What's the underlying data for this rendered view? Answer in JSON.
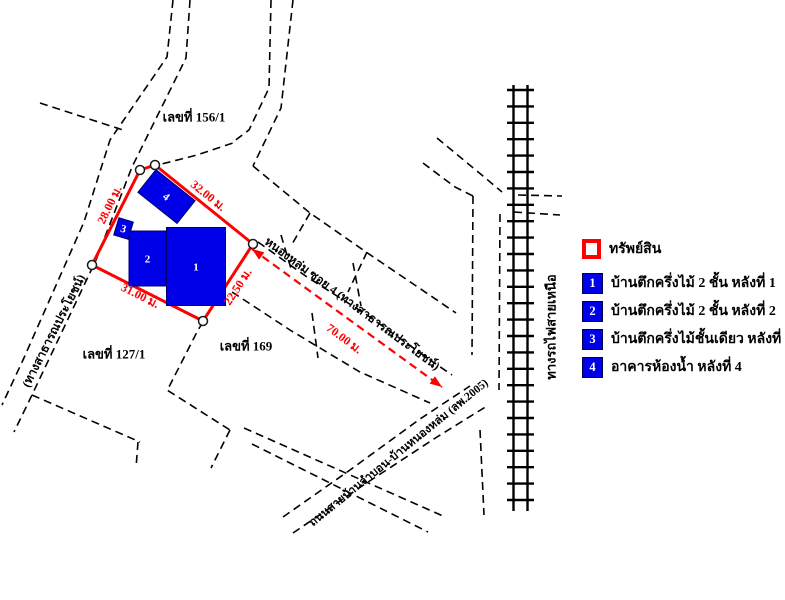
{
  "colors": {
    "property_outline": "#ff0000",
    "building_fill": "#0000e8",
    "measure_text": "#ff0000",
    "road_line": "#000000"
  },
  "legend": {
    "property_label": "ทรัพย์สิน",
    "items": [
      {
        "num": "1",
        "label": "บ้านตึกครึ่งไม้ 2 ชั้น หลังที่ 1"
      },
      {
        "num": "2",
        "label": "บ้านตึกครึ่งไม้ 2 ชั้น หลังที่ 2"
      },
      {
        "num": "3",
        "label": "บ้านตึกครึ่งไม้ชั้นเดียว หลังที่ 3"
      },
      {
        "num": "4",
        "label": "อาคารห้องน้ำ หลังที่ 4"
      }
    ]
  },
  "map": {
    "property": {
      "outline": [
        [
          140,
          170
        ],
        [
          155,
          165
        ],
        [
          253,
          244
        ],
        [
          203,
          321
        ],
        [
          92,
          265
        ]
      ]
    },
    "buildings": [
      {
        "num": "1",
        "cx": 196,
        "cy": 266.5,
        "w": 59,
        "h": 78,
        "rotate": 0
      },
      {
        "num": "2",
        "cx": 147.5,
        "cy": 258.5,
        "w": 37,
        "h": 55,
        "rotate": 0
      },
      {
        "num": "3",
        "cx": 123.5,
        "cy": 228.5,
        "w": 15,
        "h": 18,
        "rotate": 17
      },
      {
        "num": "4",
        "cx": 166.5,
        "cy": 196.5,
        "w": 50,
        "h": 29,
        "rotate": 38.5
      }
    ],
    "railway": {
      "rail_west_x": 513.5,
      "rail_east_x": 527.5,
      "y_top": 85,
      "y_bottom": 511,
      "tie_x1": 507,
      "tie_x2": 534,
      "tie_start": 90,
      "tie_step": 16.4
    },
    "measure_arrow": {
      "from": [
        252,
        249
      ],
      "to": [
        442,
        387
      ]
    },
    "roads": [
      {
        "name": "left-road-west",
        "pts": [
          [
            173,
            0
          ],
          [
            167,
            57
          ],
          [
            110,
            140
          ],
          [
            84,
            222
          ],
          [
            23,
            360
          ],
          [
            2,
            405
          ]
        ]
      },
      {
        "name": "left-road-east",
        "pts": [
          [
            190,
            0
          ],
          [
            186,
            58
          ],
          [
            132,
            167
          ],
          [
            96,
            260
          ],
          [
            32,
            395
          ],
          [
            14,
            432
          ]
        ]
      },
      {
        "name": "top-cross-line",
        "pts": [
          [
            40,
            103
          ],
          [
            123,
            130
          ]
        ]
      },
      {
        "name": "north-boundary",
        "pts": [
          [
            150,
            167
          ],
          [
            197,
            155
          ],
          [
            233,
            143
          ]
        ]
      },
      {
        "name": "road156-west",
        "pts": [
          [
            271,
            0
          ],
          [
            269,
            88
          ],
          [
            249,
            130
          ],
          [
            233,
            142
          ]
        ]
      },
      {
        "name": "road156-east",
        "pts": [
          [
            293,
            0
          ],
          [
            281,
            108
          ],
          [
            253,
            166
          ]
        ]
      },
      {
        "name": "ne-parallel",
        "pts": [
          [
            253,
            166
          ],
          [
            310,
            213
          ],
          [
            366,
            252
          ],
          [
            431,
            296
          ],
          [
            456,
            313
          ]
        ]
      },
      {
        "name": "ne-stub-1",
        "pts": [
          [
            310,
            213
          ],
          [
            291,
            246
          ]
        ]
      },
      {
        "name": "ne-stub-2",
        "pts": [
          [
            367,
            252
          ],
          [
            348,
            292
          ]
        ]
      },
      {
        "name": "soi-north-edge",
        "pts": [
          [
            258,
            242
          ],
          [
            307,
            277
          ],
          [
            367,
            315
          ],
          [
            433,
            362
          ],
          [
            452,
            375
          ]
        ]
      },
      {
        "name": "soi-south-edge",
        "pts": [
          [
            232,
            292
          ],
          [
            290,
            330
          ],
          [
            360,
            372
          ],
          [
            430,
            403
          ]
        ]
      },
      {
        "name": "soi-tick-1",
        "pts": [
          [
            281,
            235
          ],
          [
            292,
            272
          ]
        ]
      },
      {
        "name": "soi-tick-2",
        "pts": [
          [
            353,
            263
          ],
          [
            361,
            306
          ]
        ]
      },
      {
        "name": "soi-tick-3",
        "pts": [
          [
            312,
            313
          ],
          [
            318,
            358
          ]
        ]
      },
      {
        "name": "parcel-169-west",
        "pts": [
          [
            203,
            322
          ],
          [
            198,
            330
          ],
          [
            170,
            385
          ],
          [
            167,
            390
          ],
          [
            230,
            430
          ]
        ]
      },
      {
        "name": "parcel-169-stub",
        "pts": [
          [
            230,
            430
          ],
          [
            211,
            468
          ]
        ]
      },
      {
        "name": "parcel-127-south",
        "pts": [
          [
            32,
            395
          ],
          [
            140,
            442
          ]
        ]
      },
      {
        "name": "parcel-127-stub",
        "pts": [
          [
            138,
            442
          ],
          [
            136,
            468
          ]
        ]
      },
      {
        "name": "cross-road-north",
        "pts": [
          [
            244,
            428
          ],
          [
            443,
            516
          ]
        ]
      },
      {
        "name": "cross-road-south",
        "pts": [
          [
            252,
            444
          ],
          [
            428,
            532
          ]
        ]
      },
      {
        "name": "main-road-north",
        "pts": [
          [
            283,
            517
          ],
          [
            350,
            470
          ],
          [
            420,
            419
          ],
          [
            470,
            386
          ]
        ]
      },
      {
        "name": "main-road-south",
        "pts": [
          [
            293,
            533
          ],
          [
            365,
            484
          ],
          [
            437,
            437
          ],
          [
            487,
            406
          ]
        ]
      },
      {
        "name": "rail-stub-north",
        "pts": [
          [
            437,
            138
          ],
          [
            483,
            176
          ],
          [
            502,
            192
          ]
        ]
      },
      {
        "name": "rail-stub-south",
        "pts": [
          [
            423,
            163
          ],
          [
            455,
            187
          ],
          [
            473,
            196
          ]
        ]
      },
      {
        "name": "rail-east-1",
        "pts": [
          [
            518,
            195
          ],
          [
            562,
            196
          ]
        ]
      },
      {
        "name": "rail-east-2",
        "pts": [
          [
            514,
            212
          ],
          [
            560,
            215
          ]
        ]
      },
      {
        "name": "rail-side-road-w",
        "pts": [
          [
            473,
            196
          ],
          [
            472,
            355
          ]
        ]
      },
      {
        "name": "rail-side-road-e",
        "pts": [
          [
            500,
            214
          ],
          [
            499,
            390
          ]
        ]
      },
      {
        "name": "rail-side-road-s",
        "pts": [
          [
            480,
            430
          ],
          [
            484,
            515
          ]
        ]
      }
    ],
    "labels": [
      {
        "name": "house-no-156",
        "text": "เลขที่ 156/1",
        "x": 194,
        "y": 117,
        "rot": 0,
        "size": 13,
        "color": "black"
      },
      {
        "name": "house-no-127",
        "text": "เลขที่ 127/1",
        "x": 114,
        "y": 354,
        "rot": 0,
        "size": 13,
        "color": "black"
      },
      {
        "name": "house-no-169",
        "text": "เลขที่ 169",
        "x": 246,
        "y": 346,
        "rot": 0,
        "size": 13,
        "color": "black"
      },
      {
        "name": "soi-road-label",
        "text": "หนองหล่ม ซอย 4 (ทางสาธารณประโยชน์)",
        "x": 352,
        "y": 304,
        "rot": 36.5,
        "size": 12,
        "color": "black"
      },
      {
        "name": "left-road-label",
        "text": "(ทางสาธารณประโยชน์)",
        "x": 54,
        "y": 331,
        "rot": -63,
        "size": 12,
        "color": "black"
      },
      {
        "name": "main-road-label",
        "text": "ถนนสายบ้านจำบอน-บ้านหนองหล่ม (ลพ.2005)",
        "x": 399,
        "y": 453,
        "rot": -39,
        "size": 11.5,
        "color": "black"
      },
      {
        "name": "railway-label",
        "text": "ทางรถไฟสายเหนือ",
        "x": 551,
        "y": 327,
        "rot": -90,
        "size": 13,
        "color": "black"
      },
      {
        "name": "dim-left",
        "text": "28.00 ม.",
        "x": 110,
        "y": 205,
        "rot": -64,
        "size": 12,
        "color": "red"
      },
      {
        "name": "dim-top",
        "text": "32.00 ม.",
        "x": 208,
        "y": 196,
        "rot": 39,
        "size": 12,
        "color": "red"
      },
      {
        "name": "dim-right",
        "text": "22.50 ม.",
        "x": 238,
        "y": 287,
        "rot": -57,
        "size": 12,
        "color": "red"
      },
      {
        "name": "dim-bottom",
        "text": "31.00 ม.",
        "x": 140,
        "y": 296,
        "rot": 27,
        "size": 12,
        "color": "red"
      },
      {
        "name": "dim-distance",
        "text": "70.00 ม.",
        "x": 344,
        "y": 339,
        "rot": 37,
        "size": 12,
        "color": "red"
      }
    ]
  }
}
